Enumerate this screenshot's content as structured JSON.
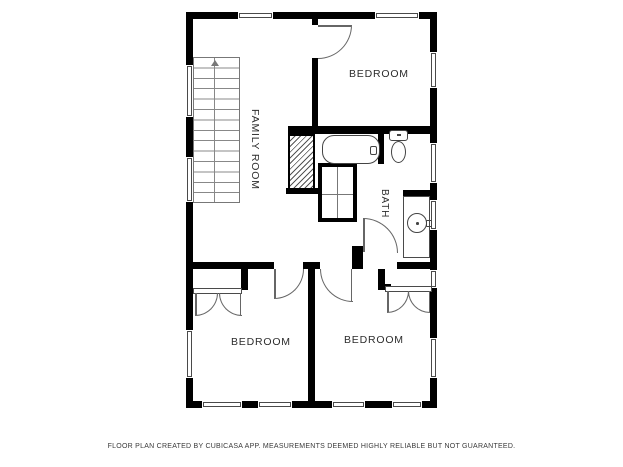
{
  "page": {
    "background": "#ffffff"
  },
  "plan": {
    "wall_color": "#000000",
    "fixture_line_color": "#555555",
    "rooms": {
      "family_room": {
        "label": "FAMILY ROOM"
      },
      "bedroom_top": {
        "label": "BEDROOM"
      },
      "bath": {
        "label": "BATH"
      },
      "bedroom_bottom_left": {
        "label": "BEDROOM"
      },
      "bedroom_bottom_right": {
        "label": "BEDROOM"
      }
    },
    "fixtures": [
      "staircase-up-arrow",
      "chimney-hatch",
      "bathtub",
      "toilet",
      "sink-vanity",
      "linen-closet",
      "closet-double-doors"
    ]
  },
  "footer": {
    "text": "FLOOR PLAN CREATED BY CUBICASA APP. MEASUREMENTS DEEMED HIGHLY RELIABLE BUT NOT GUARANTEED."
  }
}
